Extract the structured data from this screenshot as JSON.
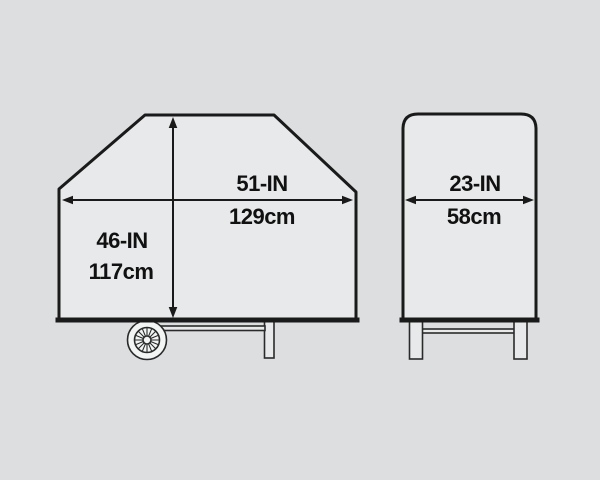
{
  "diagram": {
    "title": "grill-cover-dimension-diagram",
    "colors": {
      "background": "#dcdee0",
      "shape_fill": "#e8e9ea",
      "wheel_fill": "#f3f4f4",
      "line": "#1a1a1a",
      "text": "#111111"
    },
    "front_view": {
      "width_in": "51-IN",
      "width_cm": "129cm",
      "height_in": "46-IN",
      "height_cm": "117cm"
    },
    "side_view": {
      "depth_in": "23-IN",
      "depth_cm": "58cm"
    }
  }
}
